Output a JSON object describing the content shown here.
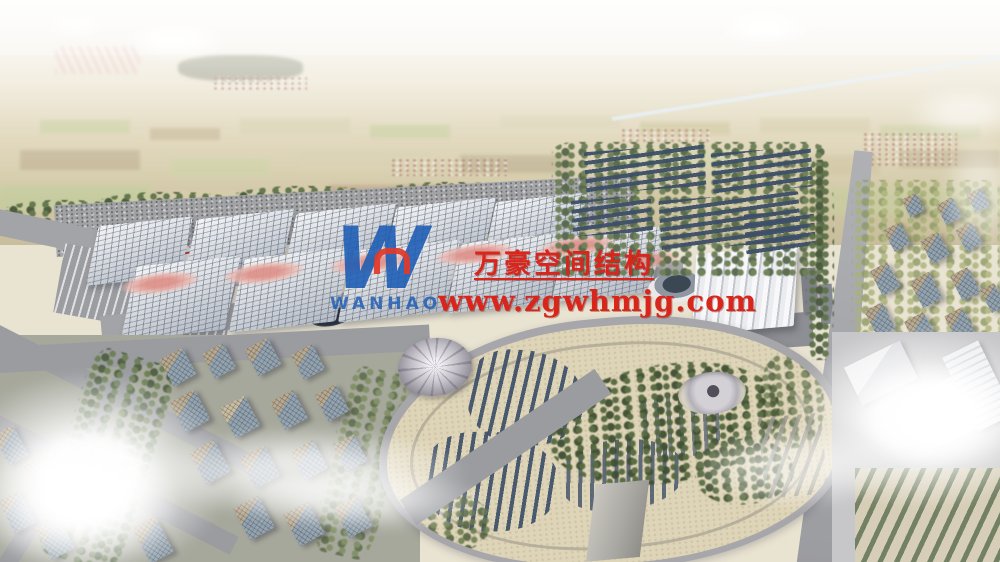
{
  "watermark": {
    "company_name": "万豪空间结构",
    "website": "www.zgwhmjg.com",
    "logo_mark": "W",
    "logo_wordmark": "WANHAO"
  },
  "palette": {
    "wm_red": "#d9261c",
    "wm_blue": "#1b5cb4",
    "logo_red": "#e03a2a",
    "ridge_pink": "#e2a49c",
    "panel_blue": "#3d4f68",
    "haze_white": "#f6f4f0",
    "park_sand": "#ded4b7",
    "road_gray": "#a3a4a8"
  },
  "scene": {
    "type": "aerial architectural rendering",
    "subject": "exhibition center complex with wave-roof halls, solar arrays, oval landscape park, residential blocks and hazy farmland horizon"
  }
}
